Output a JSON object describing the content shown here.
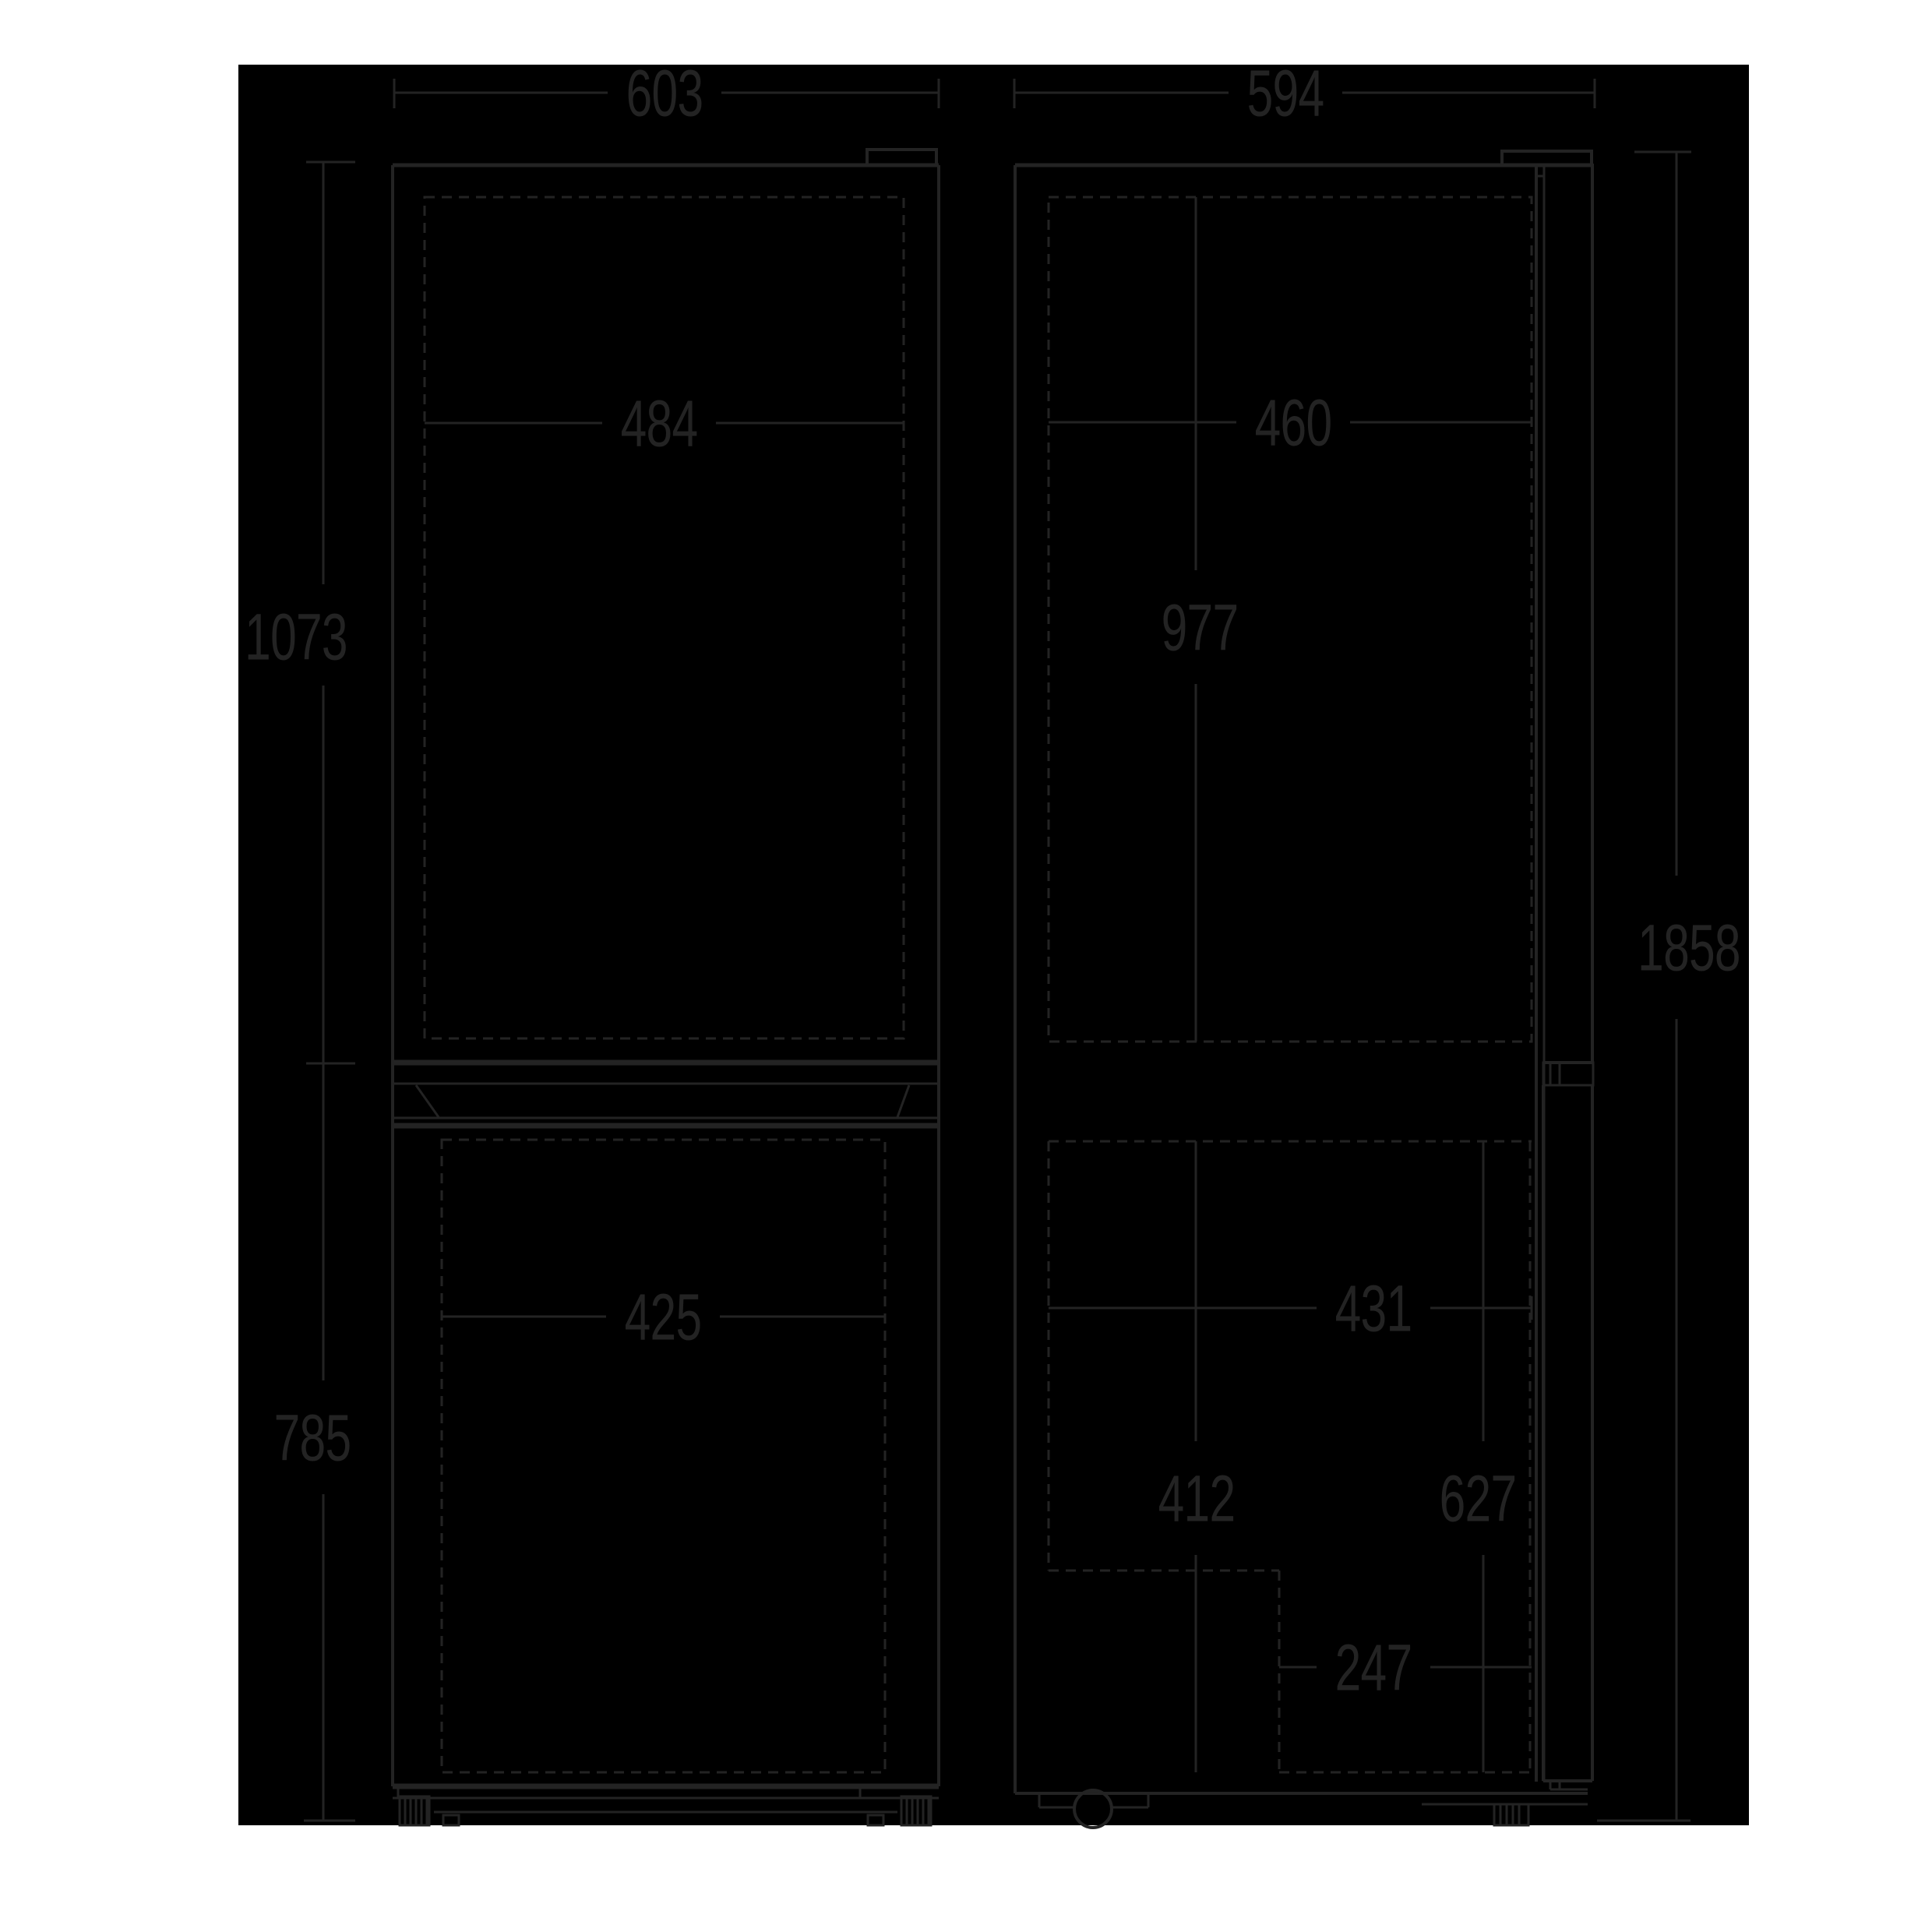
{
  "colors": {
    "page_background": "#ffffff",
    "drawing_background": "#000000",
    "ink": "#232323"
  },
  "dimensions_mm": {
    "front": {
      "overall_width": "603",
      "upper_door_inner_width": "484",
      "upper_section_height": "1073",
      "lower_door_inner_width": "425",
      "lower_section_height": "785"
    },
    "side": {
      "overall_depth": "594",
      "upper_inner_depth": "460",
      "upper_inner_height": "977",
      "overall_height": "1858",
      "lower_inner_depth": "431",
      "lower_inner_height": "412",
      "lower_depth_to_door": "627",
      "compressor_recess_depth": "247"
    }
  }
}
